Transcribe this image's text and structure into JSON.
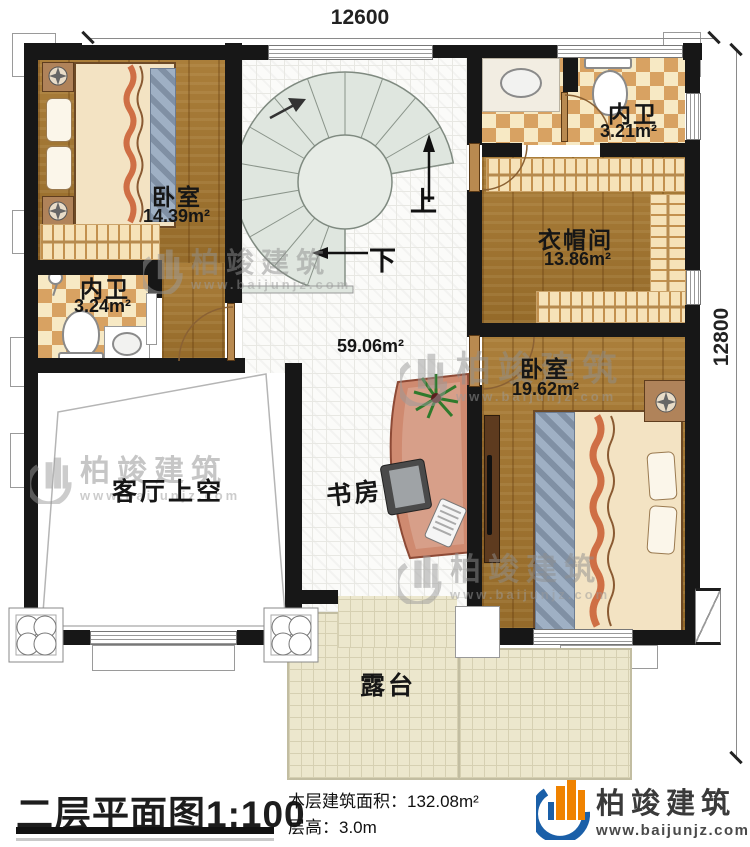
{
  "dimensions": {
    "width_mm": "12600",
    "height_mm": "12800"
  },
  "rooms": {
    "bedroom1": {
      "label": "卧室",
      "area": "14.39m²"
    },
    "bath_left": {
      "label": "内卫",
      "area": "3.24m²"
    },
    "bath_top": {
      "label": "内卫",
      "area": "3.21m²"
    },
    "cloakroom": {
      "label": "衣帽间",
      "area": "13.86m²"
    },
    "bedroom2": {
      "label": "卧室",
      "area": "19.62m²"
    },
    "hall": {
      "area": "59.06m²"
    },
    "void": {
      "label": "客厅上空"
    },
    "study": {
      "label": "书房"
    },
    "terrace": {
      "label": "露台"
    }
  },
  "stair": {
    "up_label": "上",
    "down_label": "下"
  },
  "watermark": {
    "name": "柏竣建筑",
    "url": "www.baijunjz.com"
  },
  "footer": {
    "title": "二层平面图",
    "scale": "1:100",
    "floor_area_label": "本层建筑面积：",
    "floor_area_value": "132.08m²",
    "floor_height_label": "层高：",
    "floor_height_value": "3.0m"
  },
  "brand": {
    "name": "柏竣建筑",
    "url": "www.baijunjz.com"
  },
  "colors": {
    "accent_blue": "#1a5fa8",
    "accent_orange": "#ef8200",
    "wall": "#171717"
  }
}
